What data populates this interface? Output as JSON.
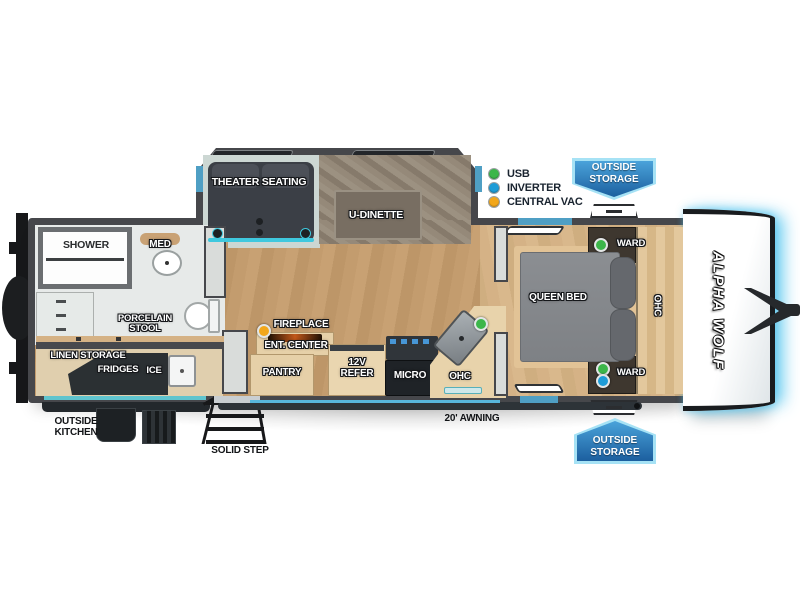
{
  "brand": "ALPHA WOLF",
  "legend": {
    "items": [
      {
        "label": "USB",
        "color": "#3cb64a"
      },
      {
        "label": "INVERTER",
        "color": "#1e9cd7"
      },
      {
        "label": "CENTRAL VAC",
        "color": "#f2a71b"
      }
    ]
  },
  "badges": {
    "top": "OUTSIDE STORAGE",
    "bottom": "OUTSIDE STORAGE"
  },
  "rooms": {
    "shower": "SHOWER",
    "med": "MED",
    "porcelain_stool": "PORCELAIN STOOL",
    "linen_storage": "LINEN STORAGE",
    "fridges": "FRIDGES",
    "ice": "ICE",
    "theater_seating": "THEATER SEATING",
    "u_dinette": "U-DINETTE",
    "fireplace": "FIREPLACE",
    "ent_center": "ENT. CENTER",
    "pantry": "PANTRY",
    "refer": "12V REFER",
    "micro": "MICRO",
    "ohc_kitchen": "OHC",
    "ohc_bedroom": "OHC",
    "queen_bed": "QUEEN BED",
    "ward_top": "WARD",
    "ward_bottom": "WARD"
  },
  "exterior": {
    "outside_kitchen": "OUTSIDE KITCHEN",
    "solid_step": "SOLID STEP",
    "awning": "20' AWNING"
  },
  "colors": {
    "wall": "#46474b",
    "window_blue": "#4f9fc4",
    "awning_trim": "#58b6dc",
    "badge_blue": "#1c5f9f",
    "usb_green": "#3cb64a",
    "inverter_blue": "#1e9cd7",
    "central_vac_yellow": "#f2a71b",
    "front_cap_glow": "#56c6f0"
  }
}
